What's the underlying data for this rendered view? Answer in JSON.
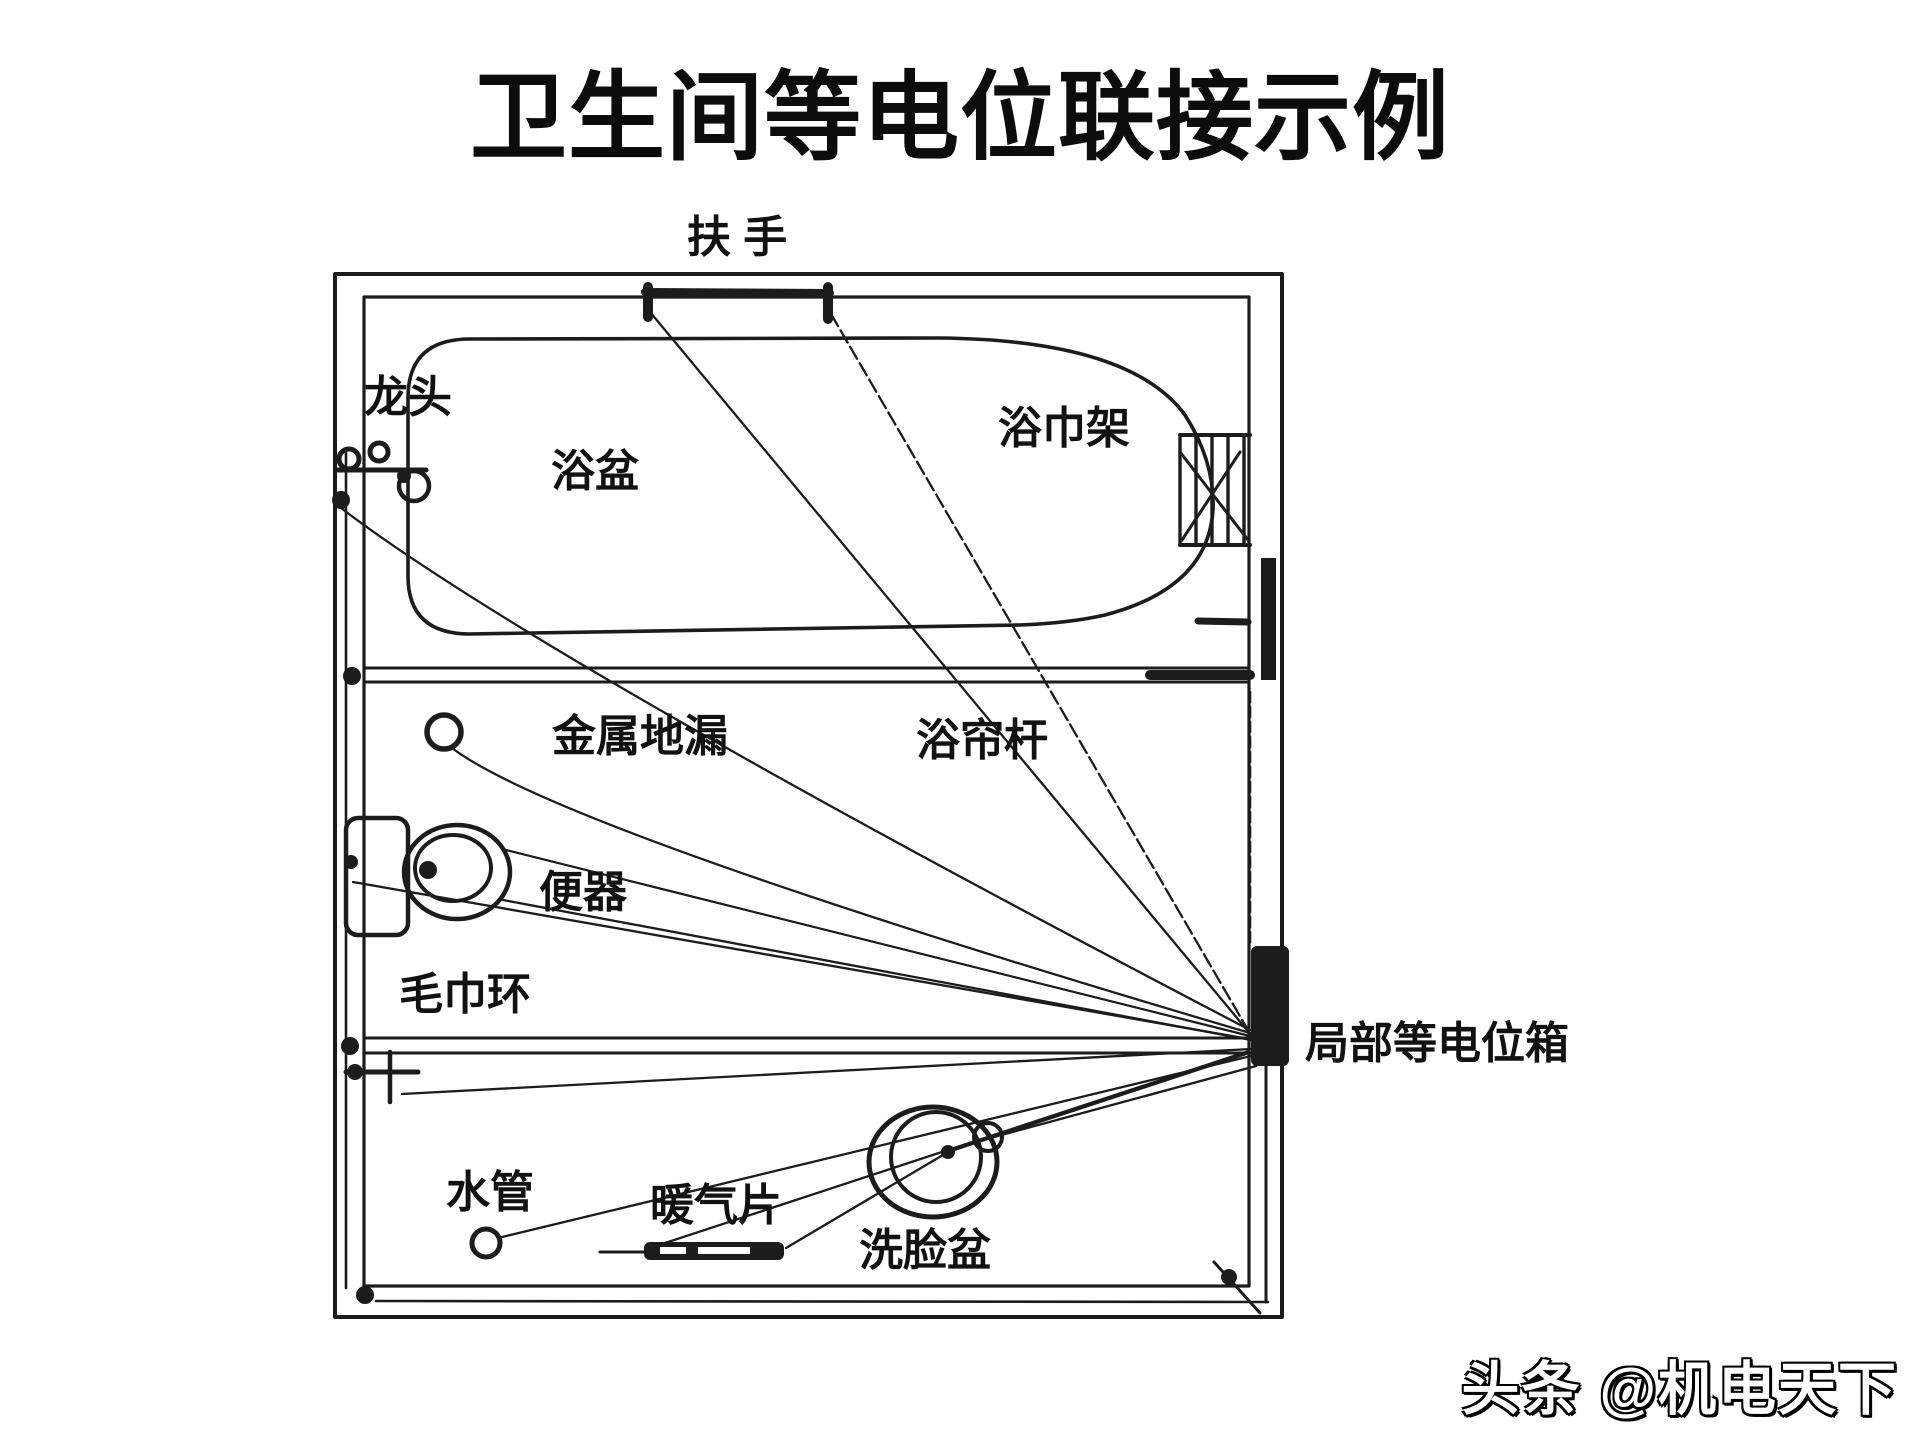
{
  "title": {
    "text": "卫生间等电位联接示例"
  },
  "watermark": {
    "text": "头条 @机电天下"
  },
  "diagram": {
    "type": "equipotential-bonding-plan",
    "colors": {
      "ink": "#1c1c1c",
      "background": "#ffffff"
    },
    "labels": {
      "handrail": "扶 手",
      "faucet": "龙头",
      "bathtub": "浴盆",
      "towel_rack": "浴巾架",
      "metal_floor_drain": "金属地漏",
      "shower_curtain_rod": "浴帘杆",
      "toilet": "便器",
      "towel_ring": "毛巾环",
      "local_equipotential_box": "局部等电位箱",
      "water_pipe": "水管",
      "radiator": "暖气片",
      "washbasin": "洗脸盆"
    }
  }
}
